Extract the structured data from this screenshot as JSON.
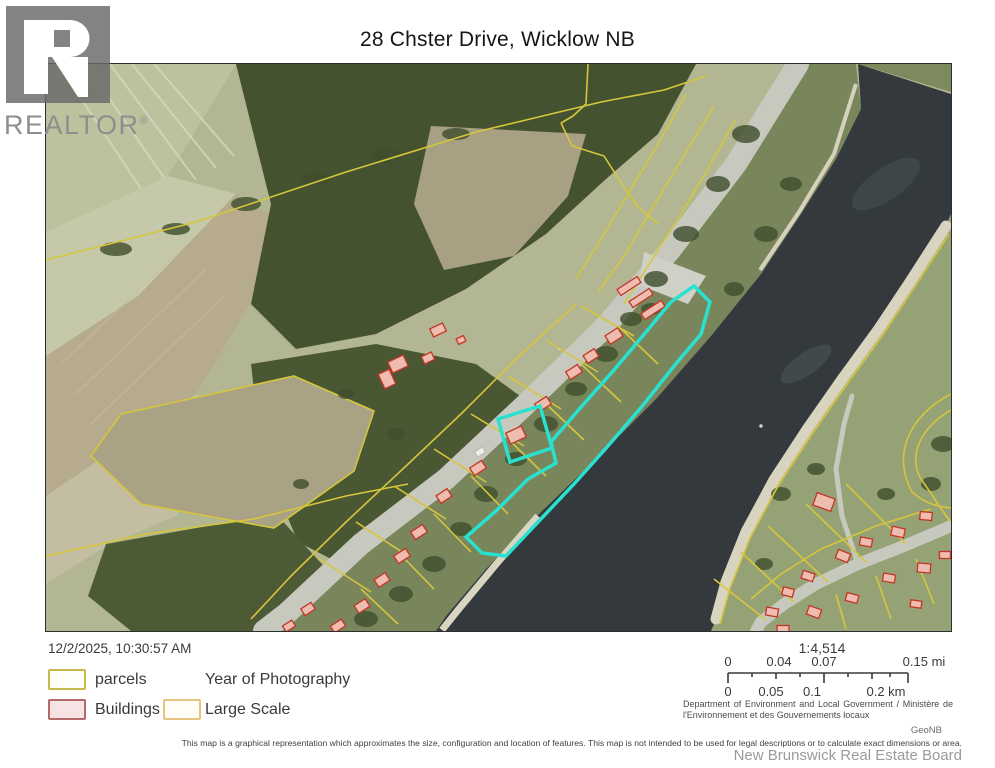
{
  "header": {
    "title": "28 Chster Drive, Wicklow NB"
  },
  "logo": {
    "text": "REALTOR",
    "registered": "®"
  },
  "map": {
    "colors": {
      "highlight": "#2ae0cf",
      "parcel_line": "#d6c63c",
      "building_outline": "#c43527",
      "building_fill": "#eebdb0",
      "water": "#33393c",
      "field": "#b2b692",
      "forest": "#45522f",
      "road": "#c7c9bf",
      "sand": "#d9d4c0"
    }
  },
  "footer": {
    "timestamp": "12/2/2025, 10:30:57 AM",
    "legend": {
      "parcels": "parcels",
      "year_of_photography": "Year of Photography",
      "buildings": "Buildings",
      "large_scale": "Large Scale"
    },
    "legend_colors": {
      "parcels_border": "#c9b94d",
      "buildings_border": "#b56a6a",
      "buildings_fill": "#f6e3e3",
      "large_scale_border": "#e4c47e"
    },
    "scale": {
      "ratio": "1:4,514",
      "miles": [
        "0",
        "0.04",
        "0.07",
        "0.15 mi"
      ],
      "kilometers": [
        "0",
        "0.05",
        "0.1",
        "0.2 km"
      ]
    },
    "attribution": "Department of Environment and Local Government / Ministère de l'Environnement et des Gouvernements locaux",
    "source": "GeoNB",
    "disclaimer": "This map is a graphical representation which approximates the size, configuration and location of features. This map is not intended to be used for legal descriptions or to calculate exact dimensions or area.",
    "board": "New Brunswick Real Estate Board"
  }
}
